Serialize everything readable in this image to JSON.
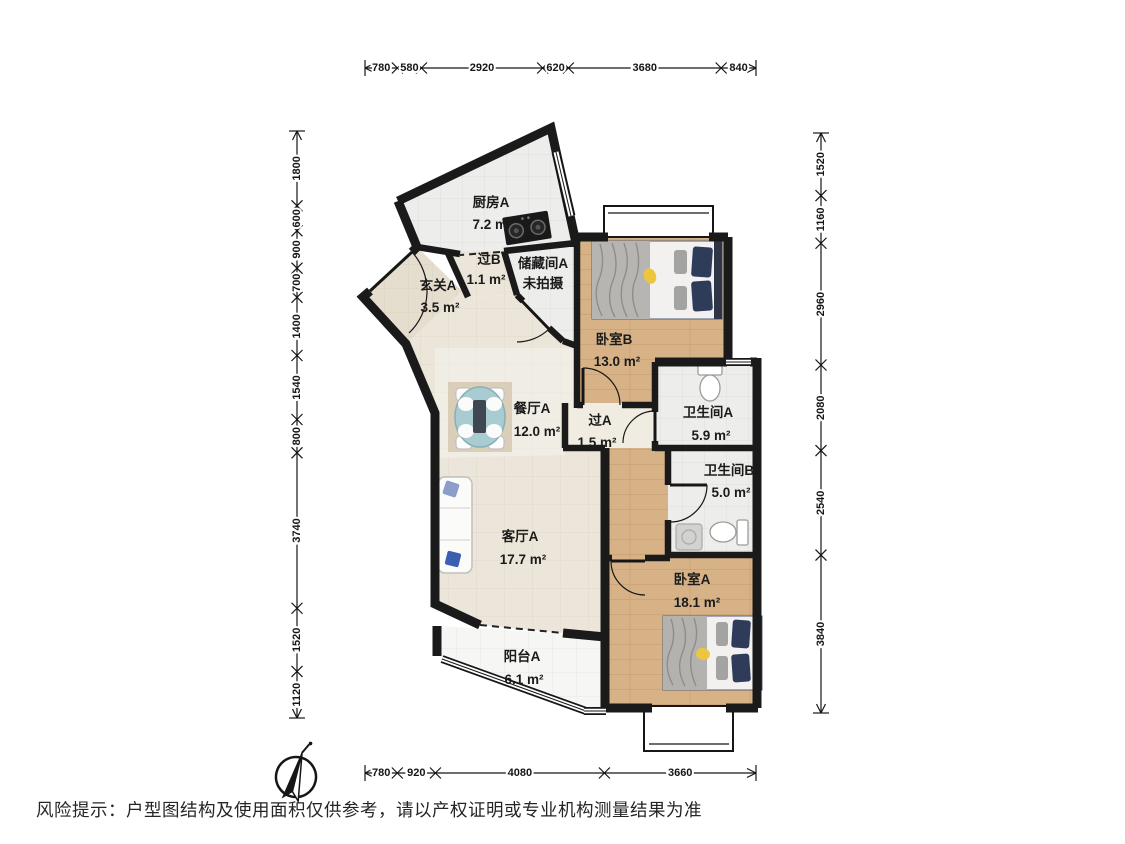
{
  "disclaimer": "风险提示：户型图结构及使用面积仅供参考，请以产权证明或专业机构测量结果为准",
  "rooms": [
    {
      "id": "kitchen",
      "name": "厨房A",
      "area": "7.2 m²"
    },
    {
      "id": "hall-b",
      "name": "过B",
      "area": "1.1 m²"
    },
    {
      "id": "storage",
      "name": "储藏间A",
      "area": "未拍摄"
    },
    {
      "id": "entry",
      "name": "玄关A",
      "area": "3.5 m²"
    },
    {
      "id": "bedroom-b",
      "name": "卧室B",
      "area": "13.0 m²"
    },
    {
      "id": "dining",
      "name": "餐厅A",
      "area": "12.0 m²"
    },
    {
      "id": "hall-a",
      "name": "过A",
      "area": "1.5 m²"
    },
    {
      "id": "bath-a",
      "name": "卫生间A",
      "area": "5.9 m²"
    },
    {
      "id": "bath-b",
      "name": "卫生间B",
      "area": "5.0 m²"
    },
    {
      "id": "living",
      "name": "客厅A",
      "area": "17.7 m²"
    },
    {
      "id": "bedroom-a",
      "name": "卧室A",
      "area": "18.1 m²"
    },
    {
      "id": "balcony",
      "name": "阳台A",
      "area": "6.1 m²"
    }
  ],
  "dimensions": {
    "top": [
      "780",
      "580",
      "2920",
      "620",
      "3680",
      "840"
    ],
    "bottom": [
      "780",
      "920",
      "4080",
      "3660"
    ],
    "left": [
      "1800",
      "600",
      "900",
      "700",
      "1400",
      "1540",
      "800",
      "3740",
      "1520",
      "1120"
    ],
    "right": [
      "1520",
      "1160",
      "2960",
      "2080",
      "2540",
      "3840"
    ]
  },
  "colors": {
    "wall": "#1a1a1a",
    "wood_floor": "#d7b287",
    "wood_line": "#c29a6e",
    "tile_floor": "#ededeb",
    "tile_line": "#dededc",
    "living_floor": "#ece6da",
    "living_line": "#e0d8c9",
    "entry_floor": "#e5ddcd",
    "balcony_floor": "#f6f6f4",
    "dining_highlight": "#f3f1ec",
    "table_accent": "#a8ccd2",
    "pillow_accent": "#2f3c59",
    "dimension_text": "#161616"
  }
}
